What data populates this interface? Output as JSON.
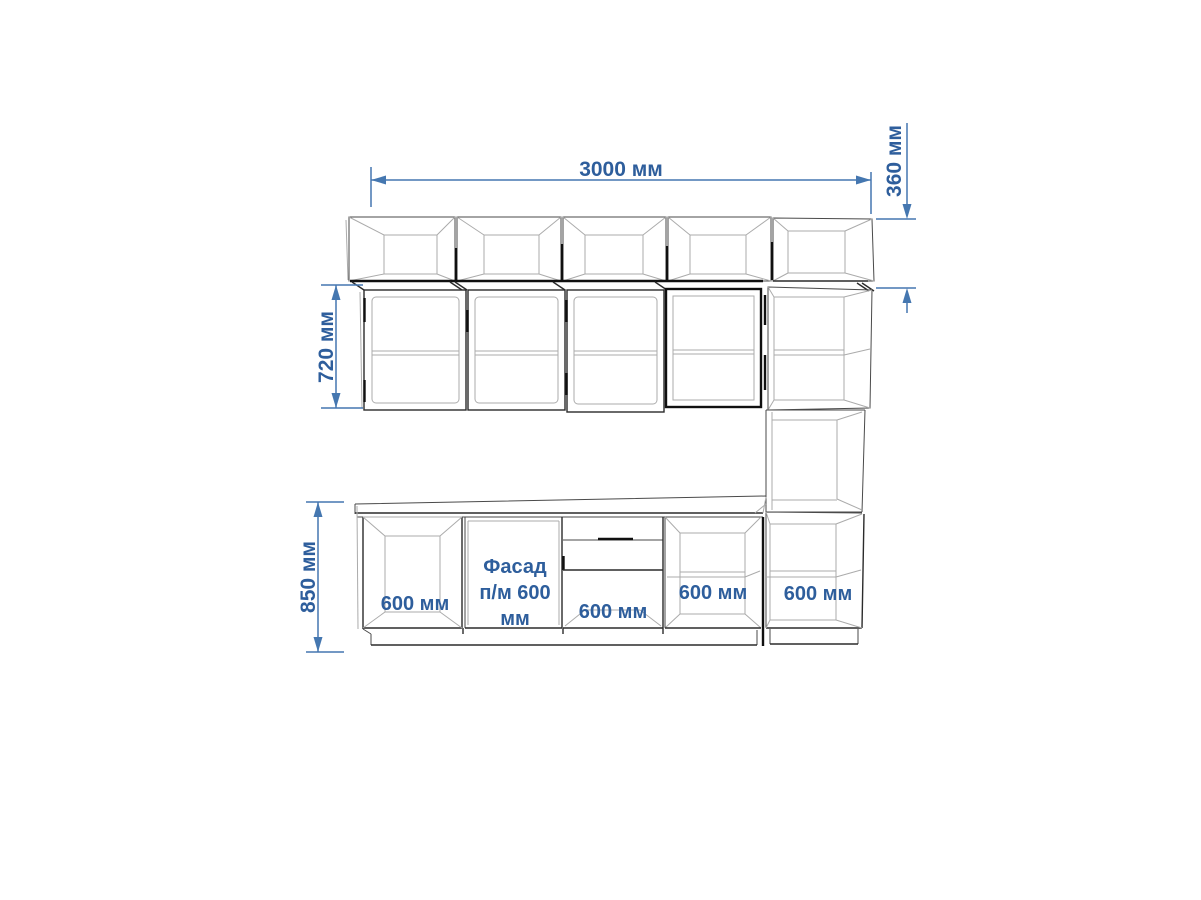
{
  "drawing": {
    "type": "kitchen-elevation-technical-drawing",
    "units": "мм"
  },
  "dimensions": {
    "total_width": "3000 мм",
    "upper_row_height": "360 мм",
    "wall_cabinet_height": "720 мм",
    "base_height": "850 мм"
  },
  "labels": {
    "base1": "600 мм",
    "facade1": "Фасад",
    "facade2": "п/м 600",
    "facade3": "мм",
    "base3": "600 мм",
    "base4": "600 мм",
    "base5": "600 мм"
  },
  "colors": {
    "dimension_line_blue": "#4577b0",
    "dimension_text_blue": "#2e5e9c",
    "outline_dark": "#2b2b2b",
    "outline_light": "#ababab",
    "background": "#ffffff"
  }
}
